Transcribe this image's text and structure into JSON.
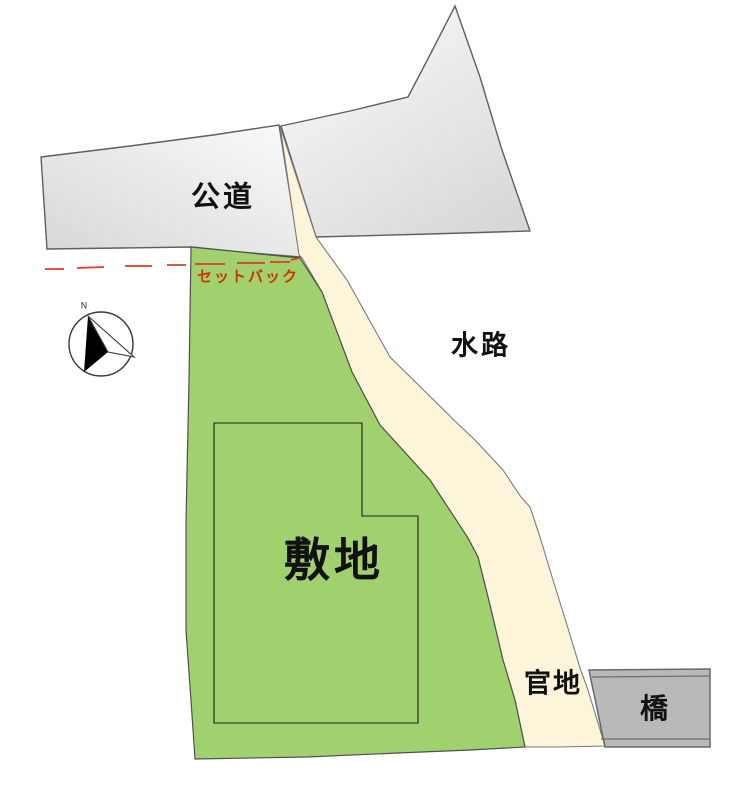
{
  "diagram": {
    "type": "site-plan",
    "labels": {
      "road": "公道",
      "waterway": "水路",
      "site": "敷地",
      "government_land": "官地",
      "bridge": "橋",
      "setback": "セットバック",
      "north": "N"
    },
    "areas": [
      {
        "name": "public-road",
        "label": "公道",
        "fill": "gray-gradient"
      },
      {
        "name": "waterway",
        "label": "水路",
        "fill": "cream"
      },
      {
        "name": "site-lot",
        "label": "敷地",
        "fill": "green",
        "contains": "building-outline"
      },
      {
        "name": "government-land",
        "label": "官地",
        "fill": "cream"
      },
      {
        "name": "bridge",
        "label": "橋",
        "fill": "gray"
      }
    ],
    "annotations": [
      {
        "name": "setback-line",
        "label": "セットバック",
        "style": "red-dashed"
      },
      {
        "name": "compass",
        "label": "N",
        "style": "circle-with-north-arrow"
      }
    ],
    "colors": {
      "site_green": "#a1d06e",
      "waterway_cream": "#fcf5d9",
      "road_light": "#fafafa",
      "road_dark": "#d7d7d7",
      "bridge_gray": "#b9b9b9",
      "bridge_line_gray": "#6e6e6e",
      "outline_gray": "#5f5f5f",
      "waterway_outline": "#7a7a7a",
      "site_outline": "#505050",
      "building_outline": "#1f1f1f",
      "setback_red": "#e03c1f",
      "setback_text_red": "#cc3300",
      "compass_black": "#000000",
      "compass_stroke": "#3a3a3a"
    }
  }
}
